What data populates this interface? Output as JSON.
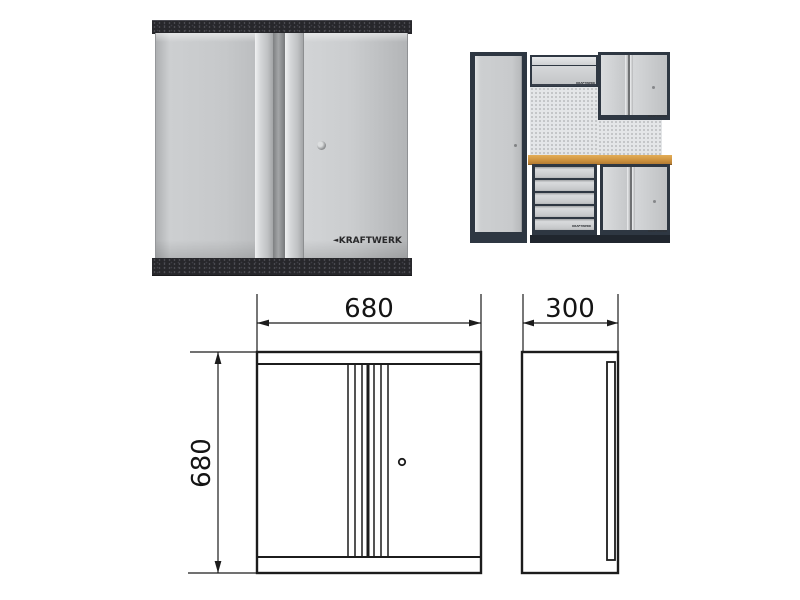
{
  "brand": "KRAFTWERK",
  "icons": {
    "brand_arrow": "◄",
    "lock": "keyhole-dot"
  },
  "colors": {
    "background": "#ffffff",
    "rail_speckled_dark": "#27272b",
    "door_gray": "#c6c8ca",
    "handle_aluminum": "#d9dbdd",
    "workshop_frame": "#2e3742",
    "pegboard_gray": "#e4e6e8",
    "worktop_wood": "#cf9440",
    "drawing_line": "#1c1c1c"
  },
  "product_photo": {
    "brand_label": "KRAFTWERK"
  },
  "workshop_photo": {
    "mini_labels": [
      "KRAFTWERK",
      "KRAFTWERK",
      "KRAFTWERK",
      "KRAFTWERK"
    ]
  },
  "drawing": {
    "front_view": {
      "width_mm": "680",
      "height_mm": "680"
    },
    "side_view": {
      "depth_mm": "300"
    }
  }
}
